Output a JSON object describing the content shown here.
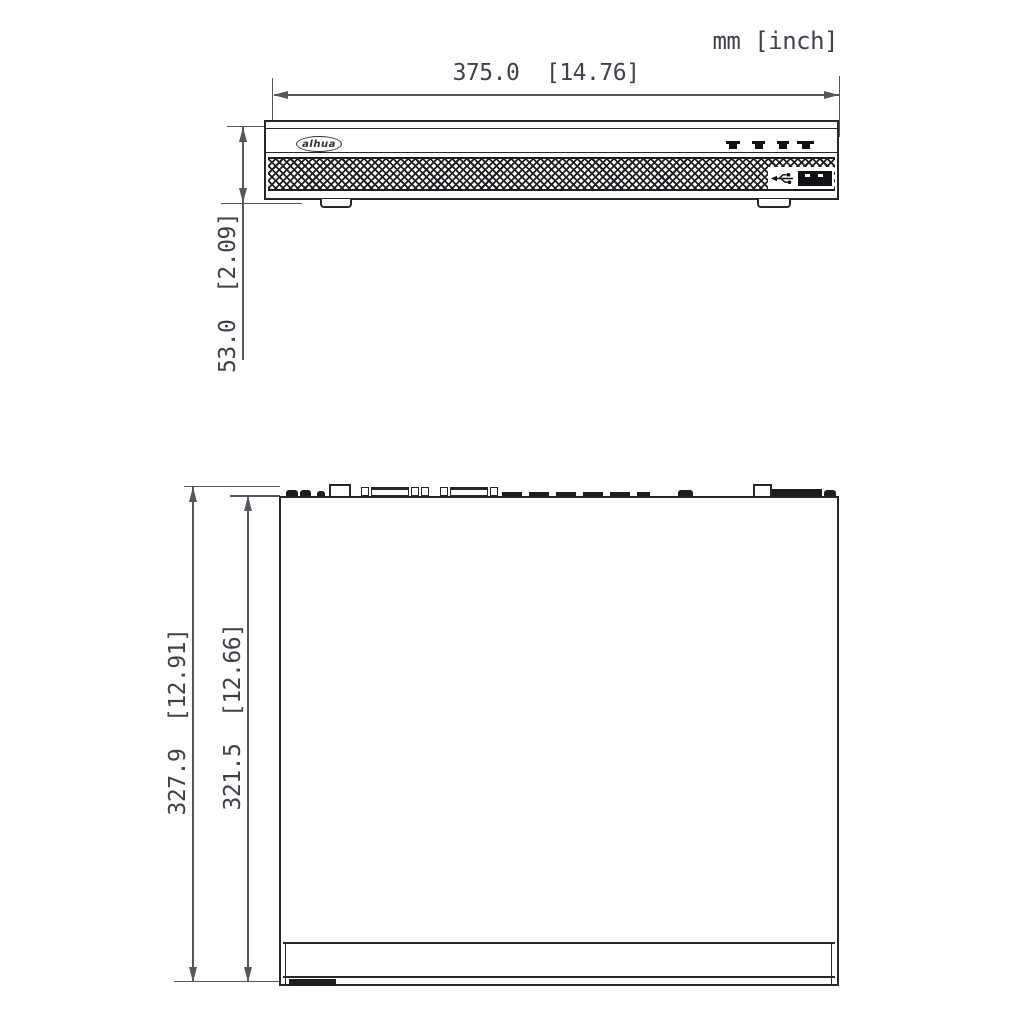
{
  "drawing": {
    "units_label": "mm [inch]",
    "brand_logo": "alhua",
    "front_view": {
      "width_dim_label": "375.0  [14.76]",
      "height_dim_label": "53.0  [2.09]"
    },
    "top_view": {
      "outer_depth_dim_label": "327.9  [12.91]",
      "inner_depth_dim_label": "321.5  [12.66]"
    },
    "icons": {
      "usb": "usb-icon",
      "indicator": "led-indicator-icon",
      "logo": "dahua-logo"
    }
  }
}
